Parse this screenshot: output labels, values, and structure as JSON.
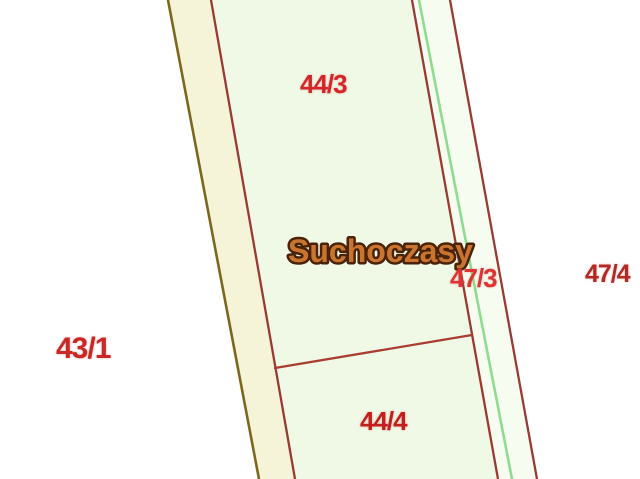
{
  "map": {
    "type": "cadastral-parcel-map",
    "village_label": "Suchoczasy",
    "parcels": {
      "p44_3": {
        "label": "44/3"
      },
      "p44_4": {
        "label": "44/4"
      },
      "p47_3": {
        "label": "47/3"
      },
      "p47_4": {
        "label": "47/4"
      },
      "p43_1": {
        "label": "43/1"
      }
    },
    "colors": {
      "background": "#ffffff",
      "parcel_fill": "#eff9e6",
      "left_strip_fill": "#f6f4d8",
      "right_strip_fill": "#f7fcf0",
      "boundary_red": "#9b3a32",
      "divider_red": "#aa3c32",
      "boundary_olive": "#7d671e",
      "boundary_green": "#8fdc8f",
      "label_44_3_color": "#d3262a",
      "label_47_3_color": "#de3333",
      "label_47_4_color": "#b22a26",
      "label_43_1_color": "#ca2727",
      "label_44_4_color": "#c41f1f",
      "village_label_fill": "#c9752f",
      "village_label_outline": "#4a2206"
    }
  }
}
